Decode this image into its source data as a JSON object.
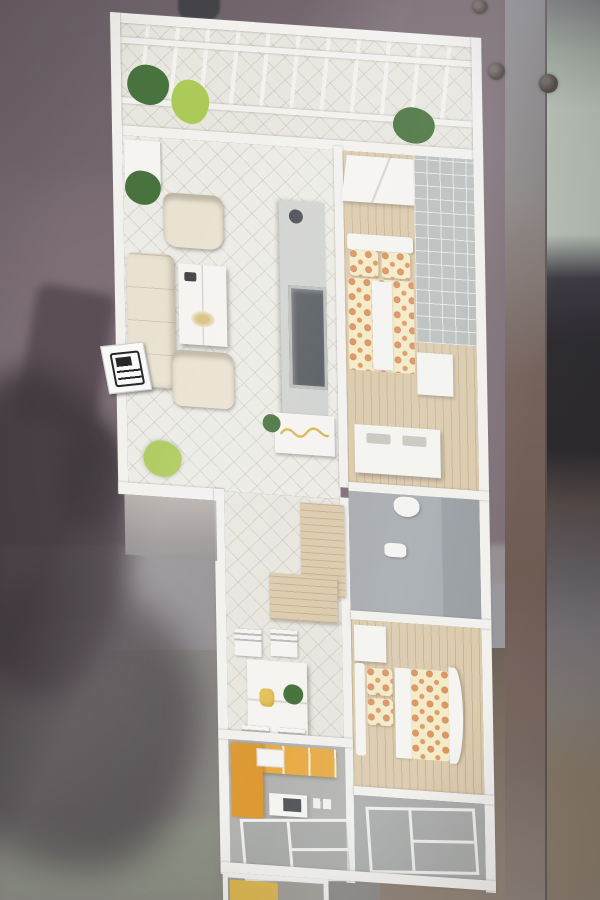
{
  "meta": {
    "type": "photograph",
    "subject": "miniature apartment floor-plan scale model shown behind display glass",
    "setting": "model mounted on a purple wall; photographer's hand and phone reflected in the glass at lower left; glass panel edge and dark reflections on the right; tiled floor at bottom"
  },
  "palette": {
    "wall_left": "#7a6a71",
    "wall_left_dark": "#675c63",
    "shadow_dark": "#372f34",
    "phone_reflection": "#4a3d44",
    "floor_band": "#908b8d",
    "floor_lower": "#85827c",
    "floor_green_corner": "#878c7c",
    "floor_brown": "#7b6c5e",
    "glass_post": "#87817f",
    "glass_band_green": "#b6c0b4",
    "glass_band_black": "#242127",
    "glass_band_brown": "#4b3e39",
    "model_wall": "#f4f3ef",
    "tile_floor": "#e9e7df",
    "living_floor": "#edece5",
    "wood_floor": "#dccaa9",
    "gray_tile_wall": "#b9bdba",
    "bath_floor": "#a5aaad",
    "balcony_floor": "#a8aaa7",
    "kitchen_floor": "#b1b2ae",
    "sofa_cream": "#ebe3d0",
    "white_furniture": "#f7f6f2",
    "tv_panel": "#d0d2ce",
    "tv_screen": "#4e5357",
    "bed_fabric": "#f6ecc3",
    "bed_dot": "#dd8a50",
    "counter_orange": "#e9a93c",
    "counter_orange_dark": "#dd9527",
    "mat_yellow": "#d9b44a",
    "plant_dark": "#3f6d33",
    "plant_light": "#a9c94f",
    "sign_white": "#fbfbf8"
  },
  "scene": {
    "background_regions": [
      "purple wall",
      "phone reflection",
      "hand-and-arm shadow reflection",
      "glass frame post",
      "glass edge bands",
      "gray floor band",
      "brown tiled floor",
      "green-gray floor corner",
      "mounting screws"
    ],
    "rooms": [
      {
        "id": "balcony-top",
        "label": "top balcony with white pergola trellis and potted plants"
      },
      {
        "id": "living-room",
        "label": "living room: cream sofa, two armchairs, coffee table, TV partition wall"
      },
      {
        "id": "bedroom-1",
        "label": "master bedroom: polka-dot double bed, canopy wardrobe, lattice window wall, dresser"
      },
      {
        "id": "bathroom",
        "label": "bathroom: toilet and sink on gray floor"
      },
      {
        "id": "dining",
        "label": "dining area: white table with four slatted chairs and plant"
      },
      {
        "id": "bedroom-2",
        "label": "second bedroom: polka-dot bed with curved footboard"
      },
      {
        "id": "balcony-2",
        "label": "bedroom balcony with grid-tile floor"
      },
      {
        "id": "kitchen",
        "label": "kitchen with orange L-shaped counter"
      },
      {
        "id": "balcony-bottom",
        "label": "bottom service balcony with yellow mat and grid tiles"
      }
    ],
    "signage": [
      {
        "id": "phone-sign",
        "label": "small white plaque with black telephone/calculator glyph on outer wall"
      }
    ]
  }
}
